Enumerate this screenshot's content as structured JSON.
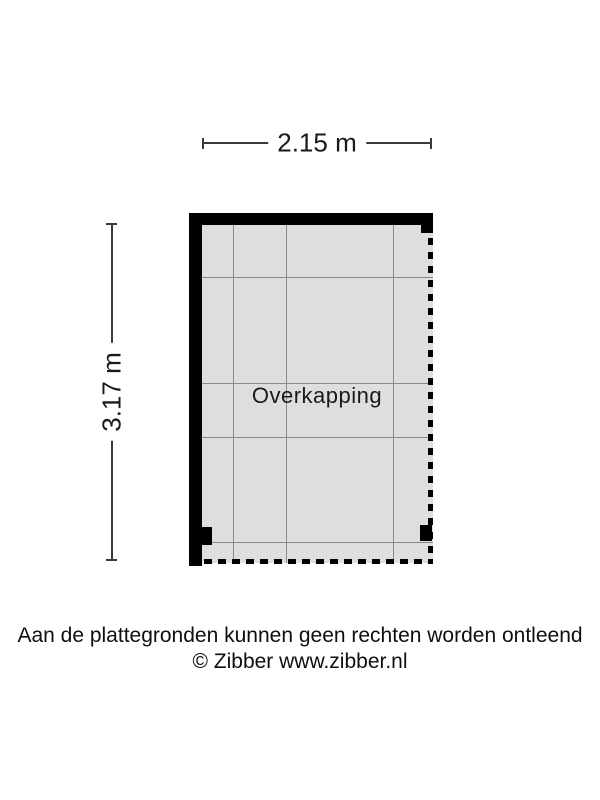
{
  "floorplan": {
    "room_label": "Overkapping",
    "width_label": "2.15 m",
    "height_label": "3.17 m",
    "geometry": {
      "grid_vertical_x": [
        233,
        286,
        393
      ],
      "grid_horizontal_y": [
        277,
        383,
        437,
        542
      ]
    }
  },
  "footer": {
    "line1": "Aan de plattegronden kunnen geen rechten worden ontleend",
    "line2": "© Zibber www.zibber.nl"
  },
  "colors": {
    "wall": "#000000",
    "interior": "#dedede",
    "grid": "#898989",
    "dimension": "#3a3a3a"
  }
}
